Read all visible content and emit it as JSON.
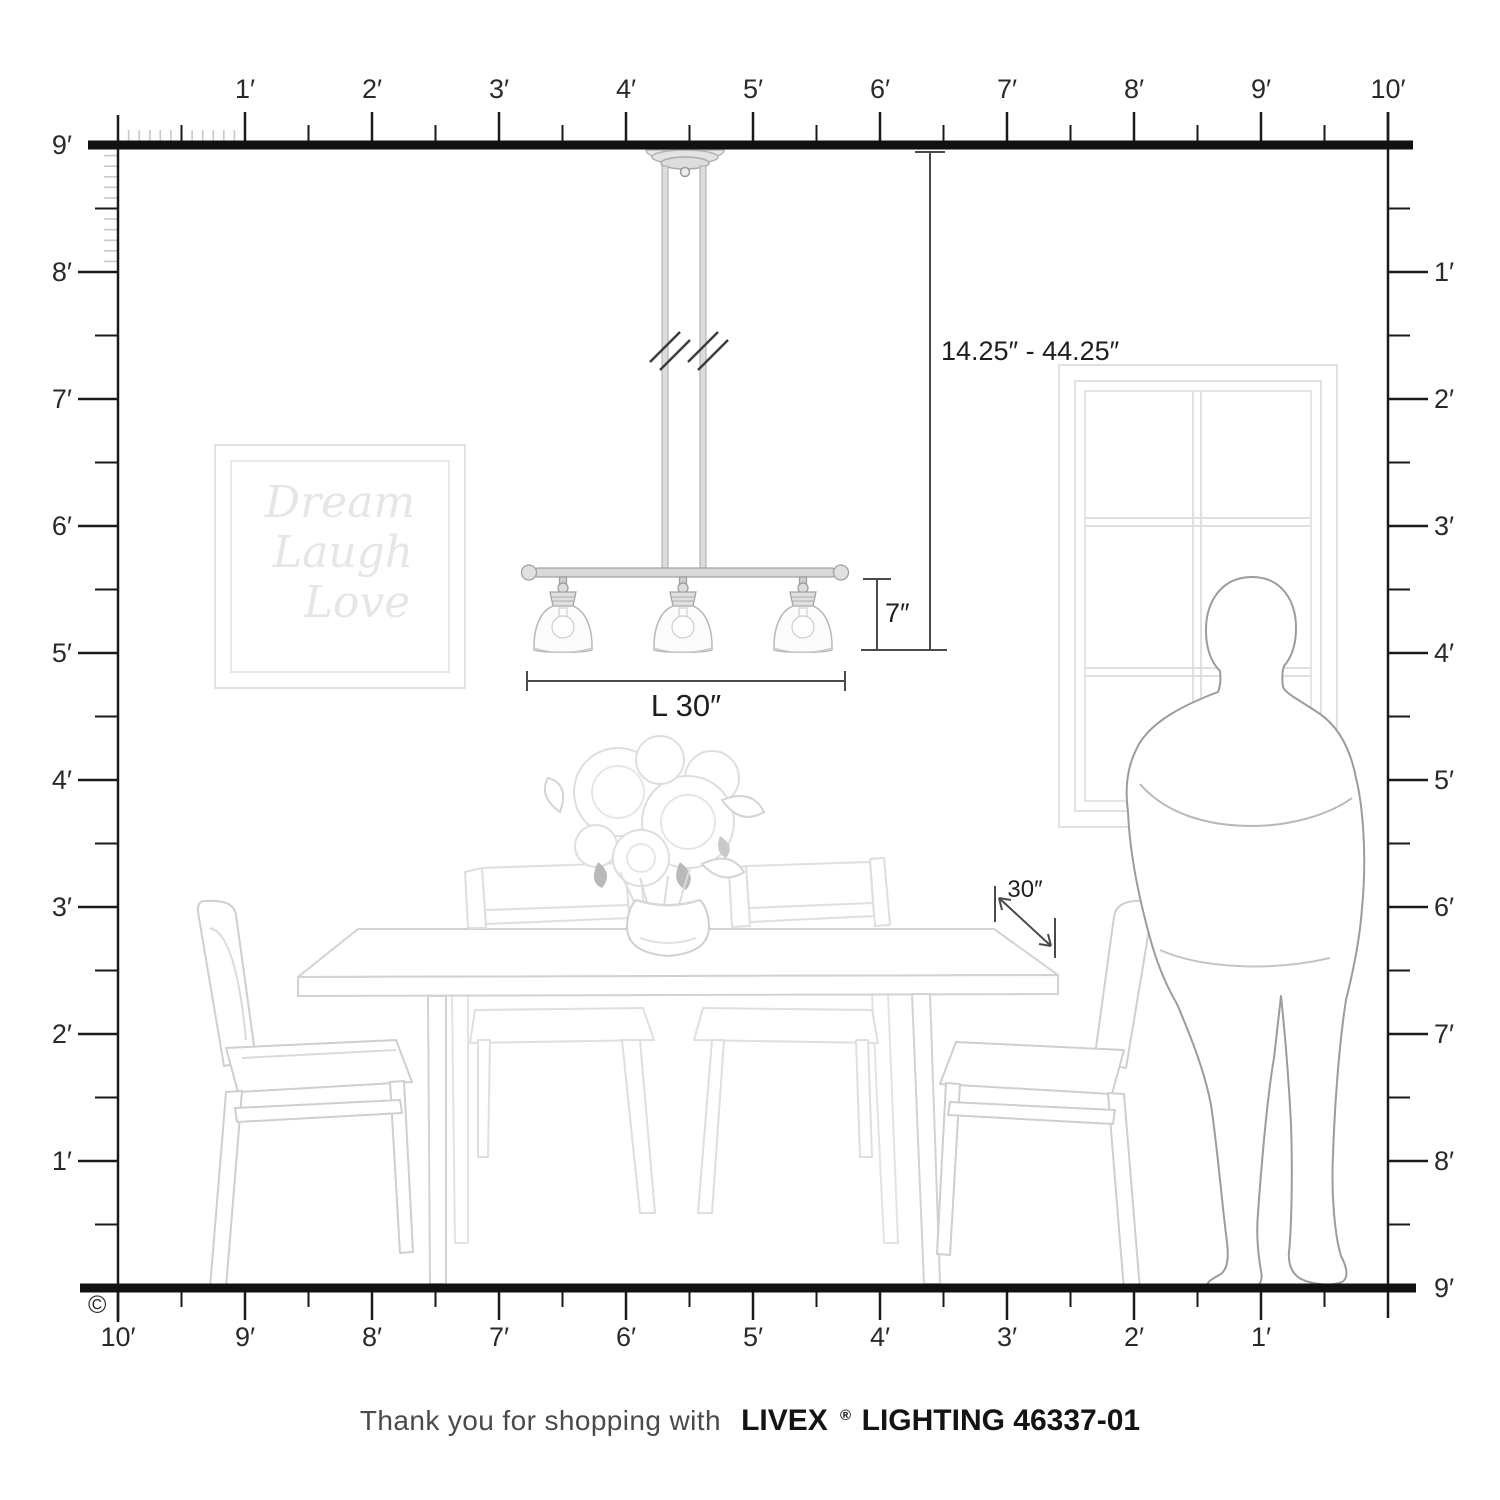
{
  "page": {
    "copyright": "©"
  },
  "rulers": {
    "top": {
      "labels": [
        "1′",
        "2′",
        "3′",
        "4′",
        "5′",
        "6′",
        "7′",
        "8′",
        "9′",
        "10′"
      ]
    },
    "bottom": {
      "labels": [
        "10′",
        "9′",
        "8′",
        "7′",
        "6′",
        "5′",
        "4′",
        "3′",
        "2′",
        "1′"
      ]
    },
    "left": {
      "labels": [
        "9′",
        "8′",
        "7′",
        "6′",
        "5′",
        "4′",
        "3′",
        "2′",
        "1′"
      ]
    },
    "right": {
      "labels": [
        "1′",
        "2′",
        "3′",
        "4′",
        "5′",
        "6′",
        "7′",
        "8′",
        "9′"
      ]
    }
  },
  "dimensions": {
    "hang_range": "14.25″ - 44.25″",
    "fixture_height": "7″",
    "fixture_length": "L 30″",
    "table_clearance": "30″"
  },
  "wall_art": {
    "lines": [
      "Dream",
      "Laugh",
      "Love"
    ]
  },
  "footer": {
    "prefix": "Thank you for shopping with",
    "brand": "LIVEX",
    "registered": "®",
    "product": "LIGHTING 46337-01"
  },
  "colors": {
    "ruler_line": "#1a1a1a",
    "dimension_line": "#4a4a4a",
    "scene_line_light": "#dcdcdc",
    "scene_line_mid": "#cfcfcf",
    "person_outline": "#9c9c9c",
    "metal_fill": "#d8d8d8",
    "accent_leaf": "#b9b9b9"
  }
}
